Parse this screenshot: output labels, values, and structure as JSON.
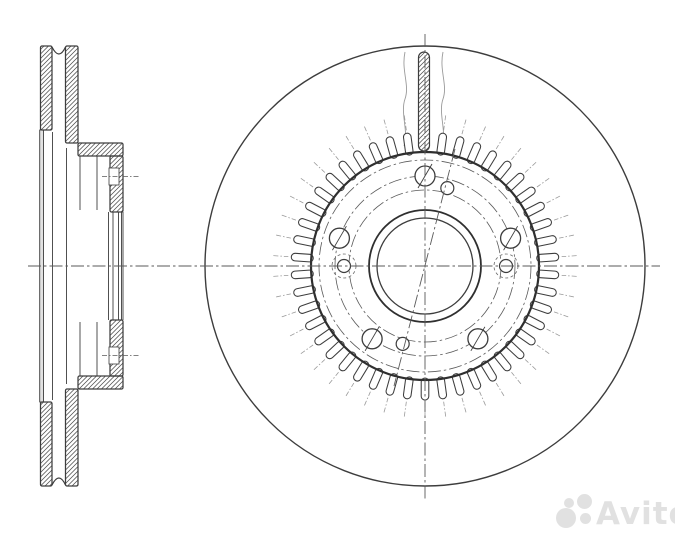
{
  "watermarks": {
    "abcp": {
      "text": "abcp",
      "color": "#9a9a9a",
      "opacity": 0.72
    },
    "avito": {
      "text": "Avito",
      "color": "#dedede",
      "opacity": 0.9
    }
  },
  "drawing": {
    "background": "#ffffff",
    "colors": {
      "line": "#3d3d3d",
      "bold": "#2f2f2f",
      "thin": "#6f6f6f",
      "gray": "#9a9a9a",
      "hatch": "#4a4a4a",
      "strip_fill": "#e2e2e2",
      "centerline": "#5a5a5a"
    },
    "front_view": {
      "cx": 425,
      "cy": 266,
      "outer_radius": 220,
      "vertical_centerline": {
        "y1": 34,
        "y2": 500
      },
      "horizontal_centerline": {
        "x1": 28,
        "x2": 660
      },
      "abs_ring": {
        "base_radius": 114,
        "tooth_inner_radius": 114,
        "tooth_outer_radius": 134,
        "tooth_width": 7.6,
        "tooth_count": 46,
        "skip_top_tooth": true,
        "tick_r1": 137,
        "tick_r2": 152
      },
      "dash_dot_circles": [
        76,
        90,
        106
      ],
      "bore": {
        "r_inner": 48,
        "r_outer": 56
      },
      "bolt_holes": {
        "pcd": 90,
        "r": 10,
        "angles_deg": [
          -90,
          -18,
          54,
          126,
          198
        ],
        "slash_dx": 7,
        "slash_dy": 12
      },
      "small_holes": {
        "pcd": 81,
        "r": 6.5,
        "dashed_ring_r": 12,
        "angles_deg": [
          0,
          180,
          -74,
          106
        ],
        "dashed_ring_on": [
          0,
          180
        ]
      },
      "diagonal_centerline": {
        "x1": 455,
        "y1": 149,
        "x2": 394,
        "y2": 386
      },
      "section_slot": {
        "cx": 424,
        "top": 52,
        "bottom": 151,
        "width": 11
      },
      "wavy_lines": [
        {
          "x": 405,
          "y1": 52,
          "y2": 146
        },
        {
          "x": 443,
          "y1": 52,
          "y2": 146
        }
      ]
    },
    "section_view": {
      "center_y": 266,
      "plates": [
        {
          "x": 40.5,
          "y": 46,
          "w": 11.5,
          "h": 84
        },
        {
          "x": 65.5,
          "y": 46,
          "w": 12.5,
          "h": 97
        },
        {
          "x": 40.5,
          "y": 402,
          "w": 11.5,
          "h": 84
        },
        {
          "x": 65.5,
          "y": 389,
          "w": 12.5,
          "h": 97
        }
      ],
      "saddles": [
        "M 52 47 Q 59 61 65.5 47",
        "M 52 485 Q 59 471 65.5 485"
      ],
      "flanges": [
        {
          "x": 78,
          "y": 143,
          "w": 45,
          "h": 13
        },
        {
          "x": 78,
          "y": 376,
          "w": 45,
          "h": 13
        }
      ],
      "hub_bars": [
        {
          "x": 110,
          "y": 156,
          "w": 13,
          "h": 56
        },
        {
          "x": 110,
          "y": 320,
          "w": 13,
          "h": 56
        }
      ],
      "notches": [
        {
          "x": 109,
          "y": 168,
          "w": 10,
          "h": 17
        },
        {
          "x": 109,
          "y": 347,
          "w": 10,
          "h": 17
        }
      ],
      "bolt_centerlines": [
        {
          "x1": 102,
          "x2": 140,
          "y": 176.5
        },
        {
          "x1": 102,
          "x2": 140,
          "y": 355.5
        }
      ],
      "gray_strip": {
        "x": 39.7,
        "y": 130,
        "w": 3.8,
        "h": 272
      },
      "vlines": [
        {
          "x": 52.5,
          "y1": 132,
          "y2": 400
        },
        {
          "x": 66.5,
          "y1": 148,
          "y2": 384
        },
        {
          "x": 80,
          "y1": 156,
          "y2": 210
        },
        {
          "x": 80,
          "y1": 322,
          "y2": 376
        },
        {
          "x": 97,
          "y1": 156,
          "y2": 210
        },
        {
          "x": 97,
          "y1": 322,
          "y2": 376
        },
        {
          "x": 108.5,
          "y1": 212,
          "y2": 320
        },
        {
          "x": 113,
          "y1": 212,
          "y2": 320
        },
        {
          "x": 118.5,
          "y1": 212,
          "y2": 320
        },
        {
          "x": 121.5,
          "y1": 212,
          "y2": 320
        },
        {
          "x": 123,
          "y1": 212,
          "y2": 320
        }
      ]
    }
  }
}
